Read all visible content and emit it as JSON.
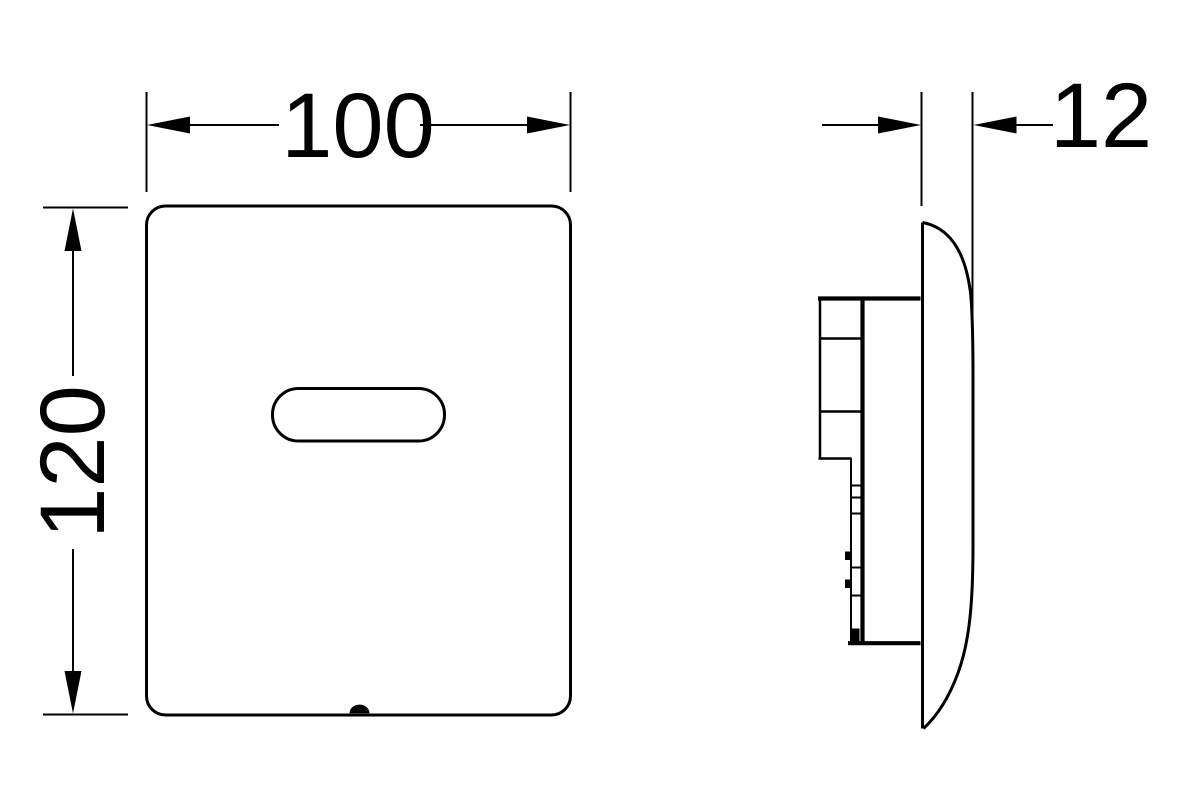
{
  "drawing": {
    "background_color": "#ffffff",
    "line_color": "#000000",
    "dimensions": {
      "width": "100",
      "height": "120",
      "depth": "12"
    }
  }
}
